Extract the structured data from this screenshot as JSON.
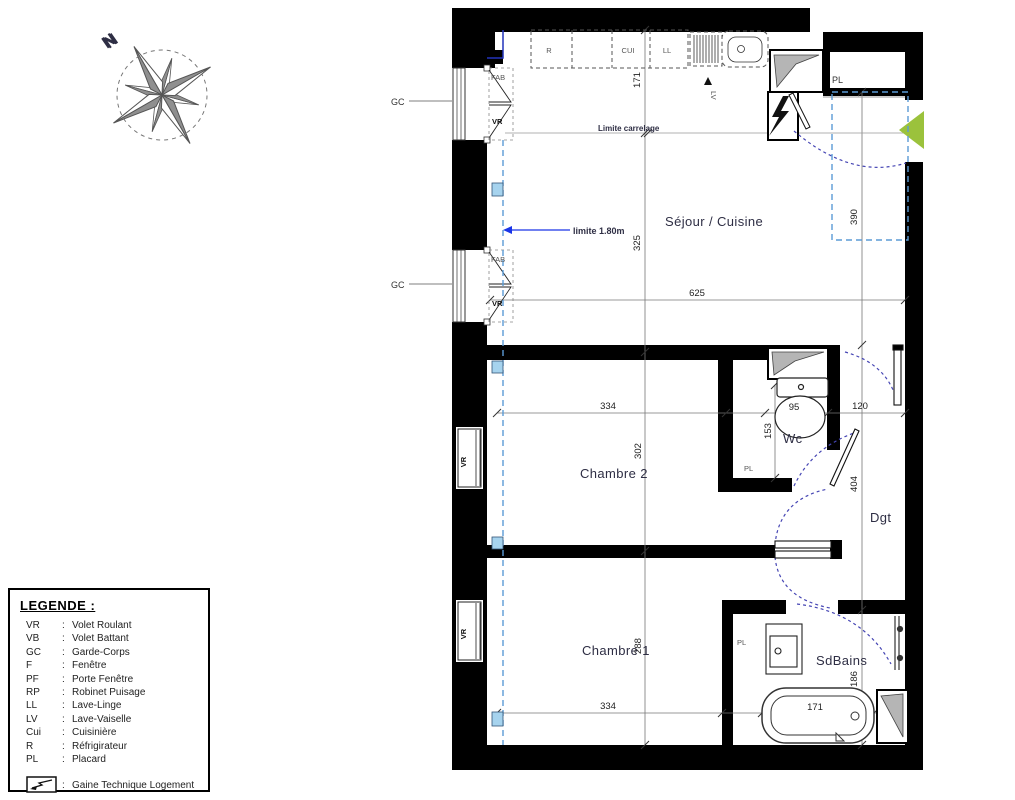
{
  "compass": {
    "north_label": "N"
  },
  "rooms": {
    "sejour": "Séjour / Cuisine",
    "chambre2": "Chambre 2",
    "chambre1": "Chambre 1",
    "wc": "Wc",
    "sdbains": "SdBains",
    "dgt": "Dgt"
  },
  "labels": {
    "gc": "GC",
    "fab": "FAB",
    "vr": "VR",
    "pl": "PL",
    "lv": "LV",
    "r": "R",
    "cui": "CUI",
    "ll": "LL",
    "limite_carrelage": "Limite carrelage",
    "limite_plafond": "limite 1.80m",
    "window_shutter": "VR"
  },
  "dimensions": {
    "kitchen_depth": "171",
    "sejour_height": "325",
    "sejour_width": "625",
    "entry_depth": "390",
    "chambre2_width": "334",
    "wc_width": "95",
    "dgt_width": "120",
    "chambre2_height": "302",
    "wc_depth": "153",
    "dgt_height": "404",
    "chambre1_height": "288",
    "chambre1_width": "334",
    "sdbains_depth": "186",
    "bathtub_length": "171"
  },
  "legend": {
    "title": "LEGENDE :",
    "colon": ":",
    "items": [
      {
        "abbr": "VR",
        "term": "Volet Roulant"
      },
      {
        "abbr": "VB",
        "term": "Volet Battant"
      },
      {
        "abbr": "GC",
        "term": "Garde-Corps"
      },
      {
        "abbr": "F",
        "term": "Fenêtre"
      },
      {
        "abbr": "PF",
        "term": "Porte Fenêtre"
      },
      {
        "abbr": "RP",
        "term": "Robinet Puisage"
      },
      {
        "abbr": "LL",
        "term": "Lave-Linge"
      },
      {
        "abbr": "LV",
        "term": "Lave-Vaiselle"
      },
      {
        "abbr": "Cui",
        "term": "Cuisinière"
      },
      {
        "abbr": "R",
        "term": "Réfrigirateur"
      },
      {
        "abbr": "PL",
        "term": "Placard"
      }
    ],
    "symbols": [
      {
        "term": "Gaine Technique Logement"
      },
      {
        "term": "Soffite ou Faux-Plafond"
      }
    ]
  },
  "colors": {
    "wall": "#000000",
    "entry_arrow": "#9bc23c",
    "door_arc": "#4646b4",
    "limit_line": "#5b9bd5",
    "limit_text": "#1a35e8",
    "soffite_fill": "#b5b5b5",
    "marker_blue": "#a6d3ee"
  }
}
